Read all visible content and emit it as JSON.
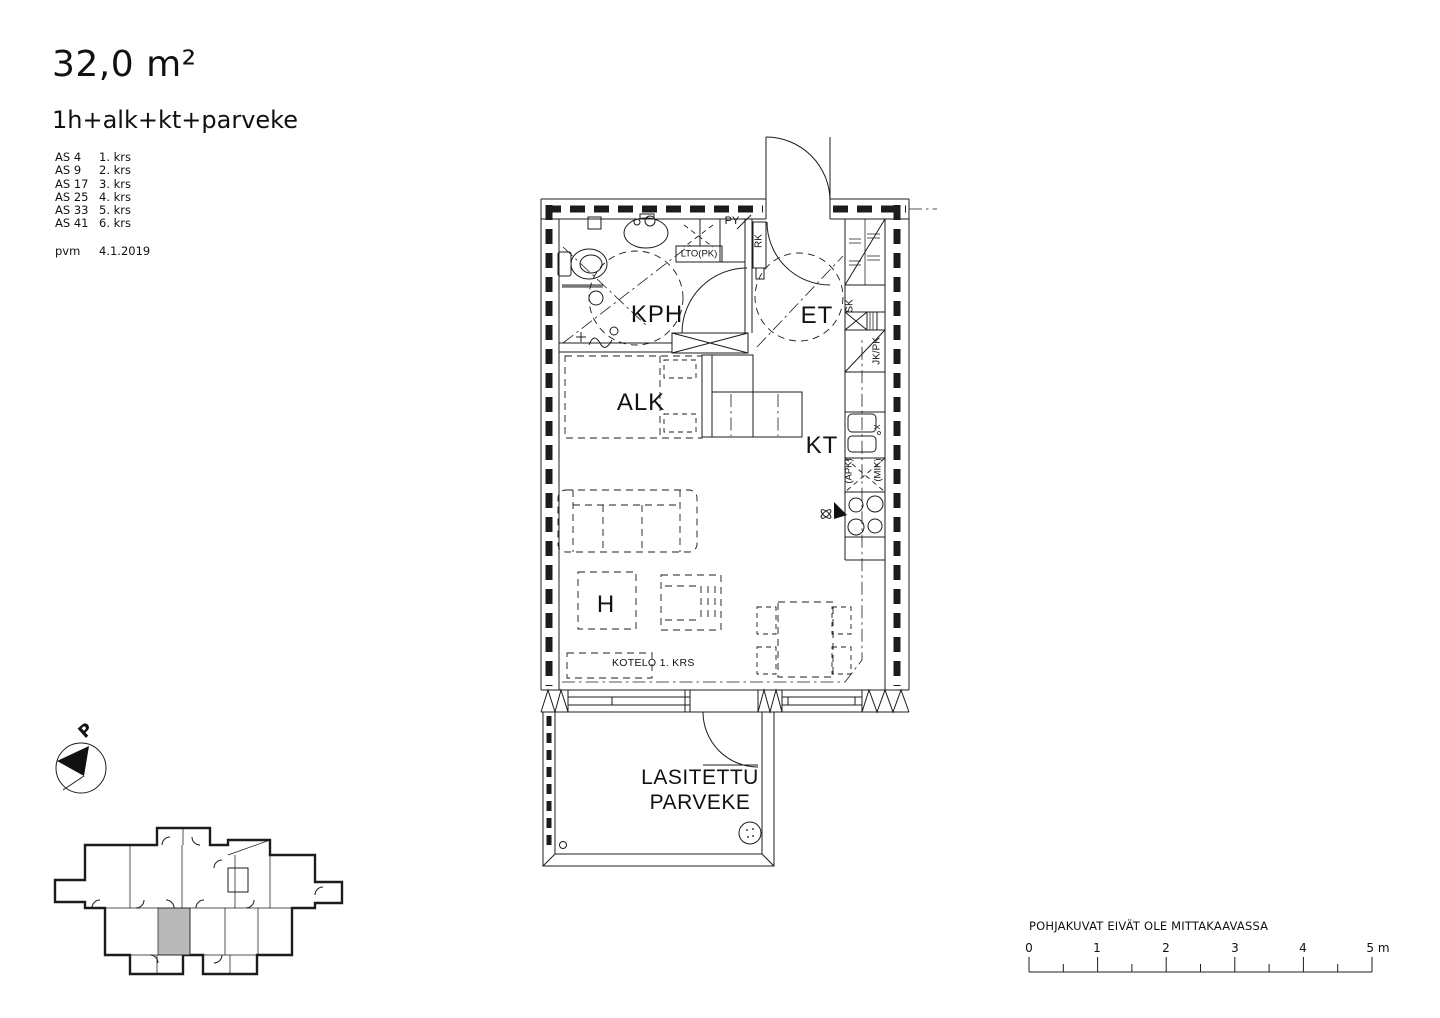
{
  "header": {
    "area": "32,0 m²",
    "layout": "1h+alk+kt+parveke",
    "apartments": [
      {
        "id": "AS 4",
        "floor": "1. krs"
      },
      {
        "id": "AS 9",
        "floor": "2. krs"
      },
      {
        "id": "AS 17",
        "floor": "3. krs"
      },
      {
        "id": "AS 25",
        "floor": "4. krs"
      },
      {
        "id": "AS 33",
        "floor": "5. krs"
      },
      {
        "id": "AS 41",
        "floor": "6. krs"
      }
    ],
    "date_label": "pvm",
    "date": "4.1.2019"
  },
  "plan": {
    "rooms": {
      "bathroom": "KPH",
      "entry": "ET",
      "alcove": "ALK",
      "kitchenette": "KT",
      "room": "H",
      "balcony_line1": "LASITETTU",
      "balcony_line2": "PARVEKE"
    },
    "annotations": {
      "duct": "KOTELO 1. KRS",
      "laundry": "PY",
      "heat_recovery": "LTO(PK)",
      "electrical_cabinet": "RK",
      "cleaning_closet": "SK",
      "fridge_freezer": "JK/PK",
      "dishwasher": "(APK)",
      "microwave": "(MIK)"
    }
  },
  "compass": {
    "north": "P"
  },
  "footer": {
    "disclaimer": "POHJAKUVAT EIVÄT OLE MITTAKAAVASSA",
    "scale_ticks": [
      "0",
      "1",
      "2",
      "3",
      "4",
      "5 m"
    ]
  },
  "colors": {
    "line": "#1c1c1c",
    "highlight": "#b9b9b9"
  }
}
